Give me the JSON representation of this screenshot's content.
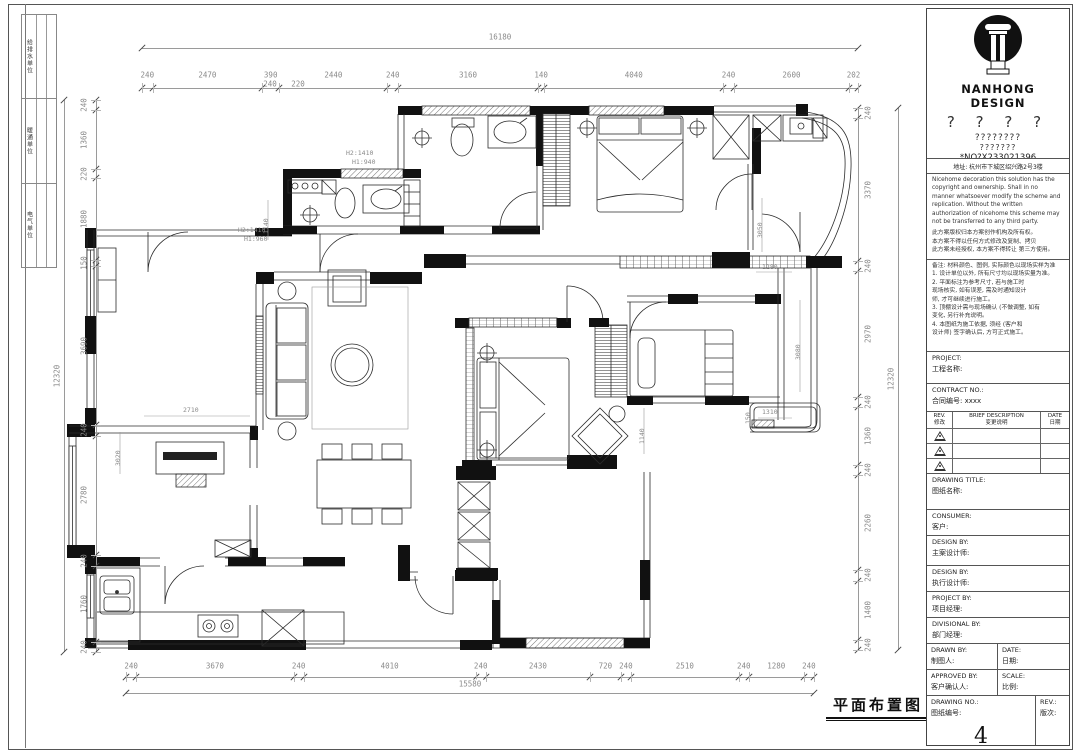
{
  "signoff": {
    "cells": [
      "给排水单位",
      "暖通单位",
      "电气单位"
    ]
  },
  "dims": {
    "top": {
      "total": "16180",
      "segments": [
        "240",
        "2470",
        "390",
        "2440",
        "240",
        "3160",
        "140",
        "4040",
        "240",
        "2600",
        "202"
      ],
      "sub": [
        "240",
        "220"
      ]
    },
    "bottom": {
      "total": "15580",
      "segments": [
        "240",
        "3670",
        "240",
        "4010",
        "240",
        "2430",
        "720",
        "240",
        "2510",
        "240",
        "1280",
        "240"
      ]
    },
    "left": {
      "total": "12320",
      "segments": [
        "240",
        "1360",
        "220",
        "1880",
        "150",
        "3690",
        "240",
        "2780",
        "240",
        "1760",
        "240"
      ]
    },
    "right": {
      "total": "12320",
      "segments": [
        "240",
        "3370",
        "240",
        "2970",
        "240",
        "1360",
        "240",
        "2260",
        "240",
        "1400",
        "240"
      ]
    }
  },
  "plan": {
    "title": "平面布置图",
    "annotations": [
      {
        "text": "H2:1410"
      },
      {
        "text": "H1:940"
      },
      {
        "text": "H2:1410"
      },
      {
        "text": "H1:960"
      },
      {
        "text": "1140"
      },
      {
        "text": "2710"
      },
      {
        "text": "3020"
      },
      {
        "text": "3050"
      },
      {
        "text": "1280"
      },
      {
        "text": "3080"
      },
      {
        "text": "1140"
      },
      {
        "text": "1310"
      },
      {
        "text": "150"
      }
    ]
  },
  "titleblock": {
    "company": "NANHONG DESIGN",
    "q1": "? ? ? ?",
    "q2": "????????",
    "q3": "???????",
    "no": "*NO?X233021396",
    "address": "地址: 杭州市下城区绍兴路2号3楼",
    "copyright_en": [
      "Nicehome decoration this solution has the",
      "copyright and ownership. Shall in no",
      "manner whatsoever modify the scheme and",
      "replication. Without the written",
      "authorization of nicehome this scheme may",
      "not be transferred to any third party."
    ],
    "copyright_cn": [
      "此方案版权归本方案创作机构及所有权。",
      "本方案不得以任何方式修改及复制、拷贝",
      "此方案未经授权, 本方案不得转让 第三方使用。"
    ],
    "notes": [
      "备注: 材料颜色、图例, 实际颜色以现场实样为准",
      "1. 设计单位以外, 所有尺寸均以现场实量为准。",
      "2. 平面标注为参考尺寸, 若与施工时",
      "现场核实, 如有误差, 需及时通知设计",
      "师, 才可继续进行施工。",
      "3. 顶棚设计需与现场确认 (不做调整, 如有",
      "变化, 另行补充说明。",
      "4. 本图纸为施工依据, 须经 (客户和",
      "设计师) 签字确认后, 方可正式施工。"
    ],
    "project_label": "PROJECT:",
    "project_cn": "工程名称:",
    "contract_label": "CONTRACT NO.:",
    "contract_cn": "合同编号: xxxx",
    "rev_h1_en": "REV.",
    "rev_h1_cn": "修改",
    "rev_h2_en": "BRIEF DESCRIPTION",
    "rev_h2_cn": "变更说明",
    "rev_h3_en": "DATE",
    "rev_h3_cn": "日期",
    "drawing_title_label": "DRAWING TITLE:",
    "drawing_title_cn": "图纸名称:",
    "consumer_label": "CONSUMER:",
    "consumer_cn": "客户:",
    "design1_label": "DESIGN BY:",
    "design1_cn": "主案设计师:",
    "design2_label": "DESIGN BY:",
    "design2_cn": "执行设计师:",
    "projectby_label": "PROJECT BY:",
    "projectby_cn": "项目经理:",
    "divisional_label": "DIVISIONAL BY:",
    "divisional_cn": "部门经理:",
    "drawn_label": "DRAWN BY:",
    "drawn_cn": "制图人:",
    "date_label": "DATE:",
    "date_cn": "日期:",
    "approved_label": "APPROVED BY:",
    "approved_cn": "客户确认人:",
    "scale_label": "SCALE:",
    "scale_cn": "比例:",
    "drawingno_label": "DRAWING NO.:",
    "drawingno_cn": "图纸编号:",
    "drawingno_value": "4",
    "rev_label": "REV.:",
    "rev_cn": "版次:"
  }
}
